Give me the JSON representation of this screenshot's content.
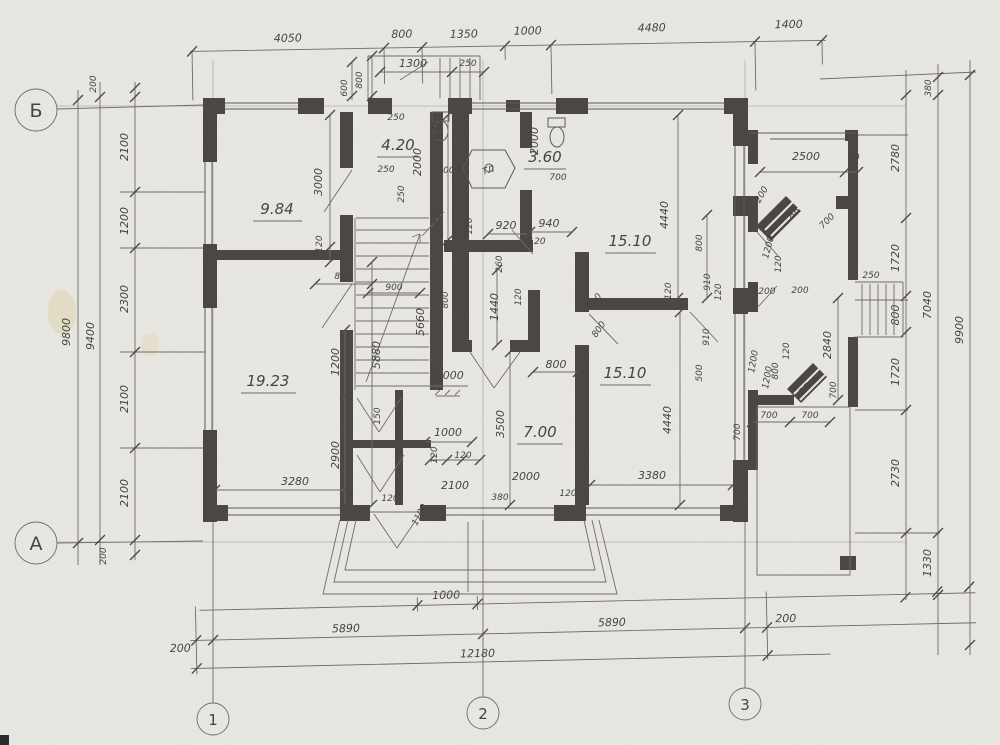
{
  "plan": {
    "axis_circles": {
      "row_top": "Б",
      "row_bottom": "А",
      "col_1": "1",
      "col_2": "2",
      "col_3": "3"
    },
    "rooms": {
      "r1": "9.84",
      "r2": "4.20",
      "r3": "3.60",
      "r4": "15.10",
      "r5": "19.23",
      "r6": "7.00",
      "r7": "15.10"
    },
    "level_mark": "0.000",
    "labels": {
      "vent1": "ВБ",
      "vent2": "ВБ",
      "fixture": "ТЛ"
    },
    "dims": {
      "top": {
        "d1": "4050",
        "d2": "800",
        "d3": "1350",
        "d4": "1000",
        "d5": "4480",
        "d6": "1400"
      },
      "top_minor": {
        "d1": "1300",
        "d2": "250",
        "d3": "800",
        "d4": "600"
      },
      "bottom": {
        "d1": "1000",
        "d2": "200",
        "d3": "5890",
        "d4": "5890",
        "d5": "200",
        "d6": "12180"
      },
      "left": {
        "out": "9800",
        "mid": "9400",
        "d1": "200",
        "d2": "2100",
        "d3": "1200",
        "d4": "2300",
        "d5": "2100",
        "d6": "2100",
        "d7": "200"
      },
      "right": {
        "d1": "380",
        "d2": "2780",
        "d3": "1720",
        "d4": "800",
        "d5": "1720",
        "d6": "2730",
        "d7": "1330",
        "mid": "7040",
        "out": "9900"
      },
      "room_left": {
        "d1": "3000",
        "d2": "120",
        "d3": "800",
        "d4": "5880",
        "d5": "1200",
        "d6": "2900",
        "d7": "3280",
        "d8": "120"
      },
      "stair": {
        "d1": "900",
        "d2": "5660",
        "d3": "800",
        "d4": "1000",
        "d5": "120",
        "d6": "120",
        "d7": "2100",
        "d8": "1100",
        "d9": "150"
      },
      "center": {
        "d1": "380",
        "d2": "120",
        "d3": "2000",
        "d4": "3500",
        "d5": "1440",
        "d6": "120",
        "d7": "800",
        "d8": "900",
        "d9": "800"
      },
      "baths": {
        "d1": "250",
        "d2": "250",
        "d3": "250",
        "d4": "2850",
        "d5": "2000",
        "d6": "700",
        "d7": "120",
        "d8": "2000",
        "d9": "700",
        "d10": "940",
        "d11": "920",
        "d12": "120",
        "d13": "260",
        "d14": "120"
      },
      "right_rooms": {
        "d1": "4440",
        "d2": "800",
        "d3": "910",
        "d4": "120",
        "d5": "120",
        "d6": "200",
        "d7": "1200",
        "d8": "1200",
        "d9": "4440",
        "d10": "3380",
        "d11": "910",
        "d12": "500",
        "d13": "700",
        "d14": "1200"
      },
      "annex": {
        "d1": "2500",
        "d2": "50",
        "d3": "700",
        "d4": "1200",
        "d5": "120",
        "d6": "200",
        "d7": "2840",
        "d8": "120",
        "d9": "800",
        "d10": "700",
        "d11": "700",
        "d12": "700",
        "d13": "250"
      }
    }
  }
}
